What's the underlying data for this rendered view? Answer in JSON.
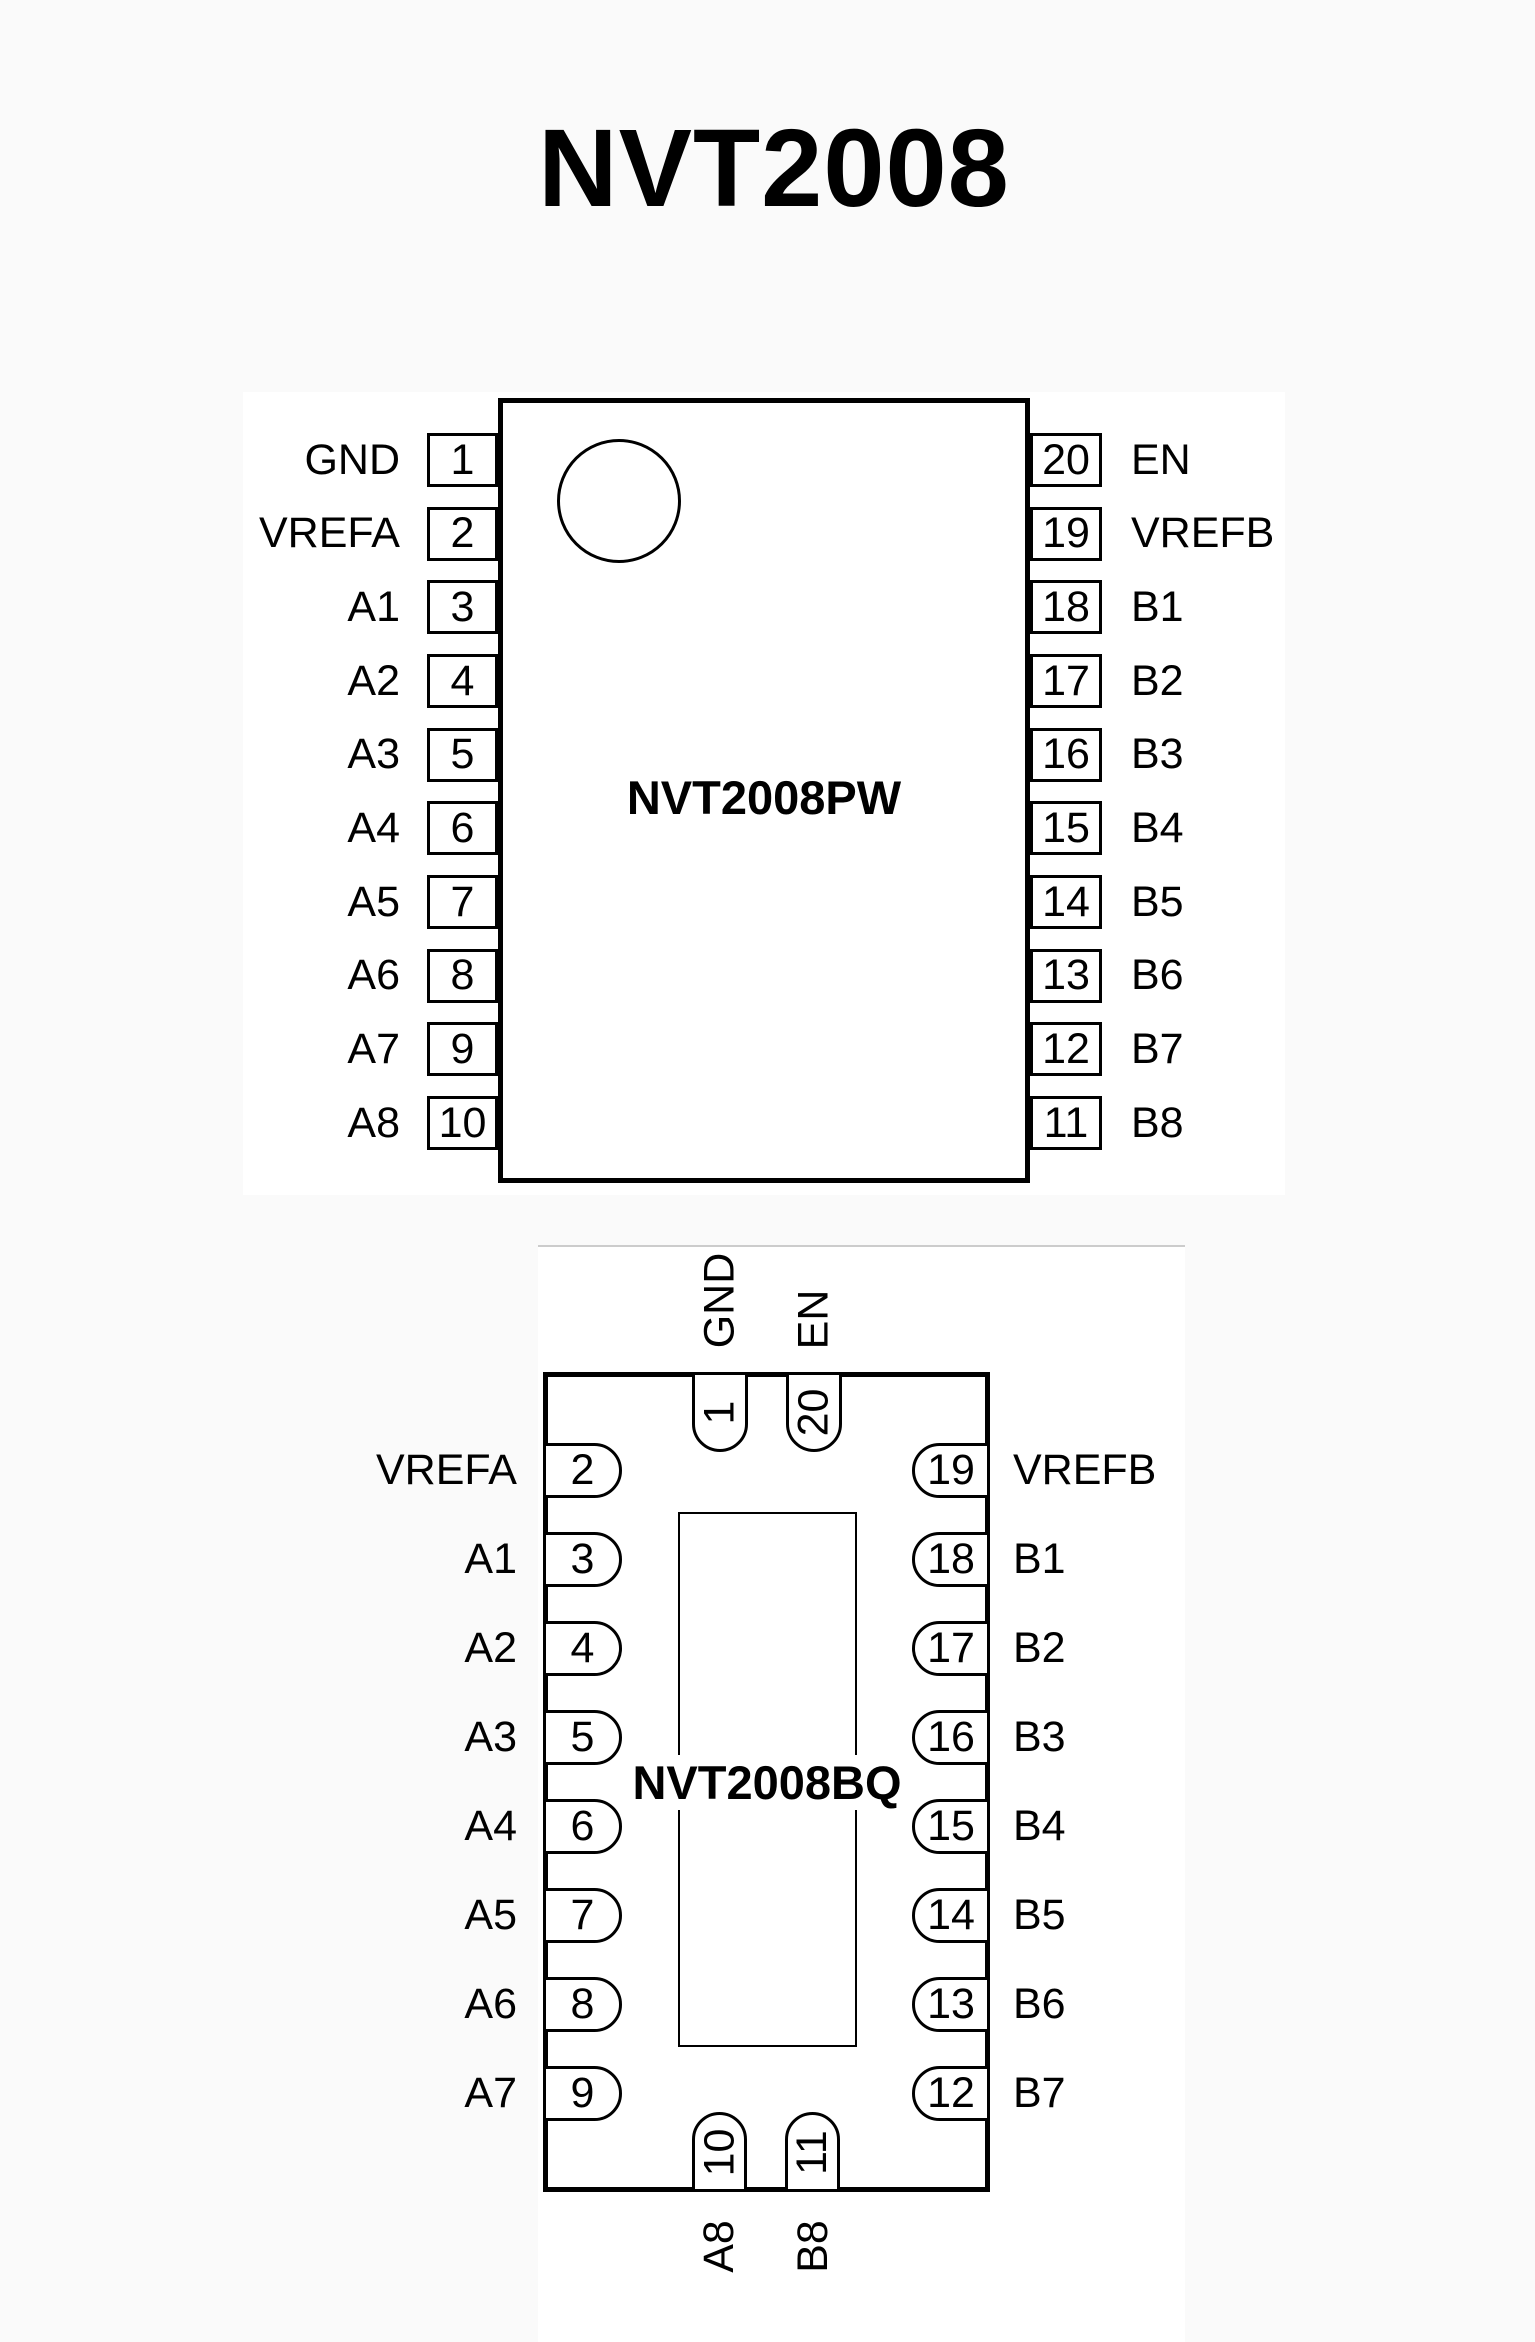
{
  "page": {
    "title": "NVT2008",
    "background_color": "#fafafa",
    "figure_background_color": "#ffffff",
    "ink_color": "#000000",
    "faint_border_color": "#cccccc"
  },
  "pw_package": {
    "name": "NVT2008PW",
    "pin1_marker": "circle-icon",
    "left_pins": [
      {
        "number": "1",
        "label": "GND"
      },
      {
        "number": "2",
        "label": "VREFA"
      },
      {
        "number": "3",
        "label": "A1"
      },
      {
        "number": "4",
        "label": "A2"
      },
      {
        "number": "5",
        "label": "A3"
      },
      {
        "number": "6",
        "label": "A4"
      },
      {
        "number": "7",
        "label": "A5"
      },
      {
        "number": "8",
        "label": "A6"
      },
      {
        "number": "9",
        "label": "A7"
      },
      {
        "number": "10",
        "label": "A8"
      }
    ],
    "right_pins": [
      {
        "number": "20",
        "label": "EN"
      },
      {
        "number": "19",
        "label": "VREFB"
      },
      {
        "number": "18",
        "label": "B1"
      },
      {
        "number": "17",
        "label": "B2"
      },
      {
        "number": "16",
        "label": "B3"
      },
      {
        "number": "15",
        "label": "B4"
      },
      {
        "number": "14",
        "label": "B5"
      },
      {
        "number": "13",
        "label": "B6"
      },
      {
        "number": "12",
        "label": "B7"
      },
      {
        "number": "11",
        "label": "B8"
      }
    ]
  },
  "bq_package": {
    "name": "NVT2008BQ",
    "top_pins": [
      {
        "number": "1",
        "label": "GND"
      },
      {
        "number": "20",
        "label": "EN"
      }
    ],
    "left_pins": [
      {
        "number": "2",
        "label": "VREFA"
      },
      {
        "number": "3",
        "label": "A1"
      },
      {
        "number": "4",
        "label": "A2"
      },
      {
        "number": "5",
        "label": "A3"
      },
      {
        "number": "6",
        "label": "A4"
      },
      {
        "number": "7",
        "label": "A5"
      },
      {
        "number": "8",
        "label": "A6"
      },
      {
        "number": "9",
        "label": "A7"
      }
    ],
    "right_pins": [
      {
        "number": "19",
        "label": "VREFB"
      },
      {
        "number": "18",
        "label": "B1"
      },
      {
        "number": "17",
        "label": "B2"
      },
      {
        "number": "16",
        "label": "B3"
      },
      {
        "number": "15",
        "label": "B4"
      },
      {
        "number": "14",
        "label": "B5"
      },
      {
        "number": "13",
        "label": "B6"
      },
      {
        "number": "12",
        "label": "B7"
      }
    ],
    "bottom_pins": [
      {
        "number": "10",
        "label": "A8"
      },
      {
        "number": "11",
        "label": "B8"
      }
    ]
  }
}
